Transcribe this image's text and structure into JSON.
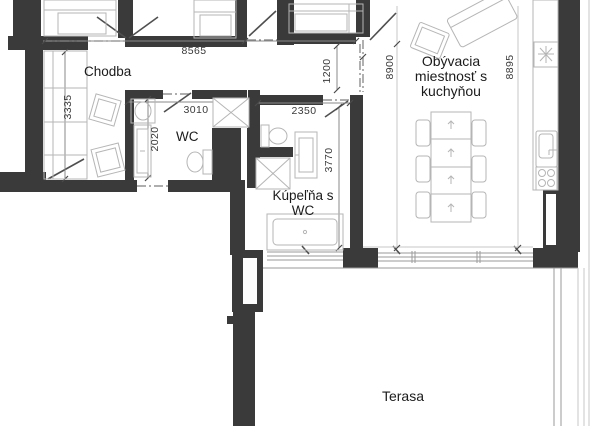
{
  "plan": {
    "rooms": {
      "chodba": {
        "label": "Chodba"
      },
      "wc": {
        "label": "WC"
      },
      "kupelna": {
        "label_line1": "Kúpeľňa s",
        "label_line2": "WC"
      },
      "obyvacia": {
        "label_line1": "Obývacia",
        "label_line2": "miestnosť s",
        "label_line3": "kuchyňou"
      },
      "terasa": {
        "label": "Terasa"
      }
    },
    "dimensions": {
      "d8565": "8565",
      "d3335": "3335",
      "d3010": "3010",
      "d2020": "2020",
      "d2350": "2350",
      "d3770": "3770",
      "d1200": "1200",
      "d8900": "8900",
      "d8895": "8895"
    },
    "colors": {
      "wall": "#3a3a3a",
      "furniture_line": "#b5b5b5",
      "dimension_text": "#3a3a3a",
      "label_text": "#1b1b1b"
    }
  }
}
